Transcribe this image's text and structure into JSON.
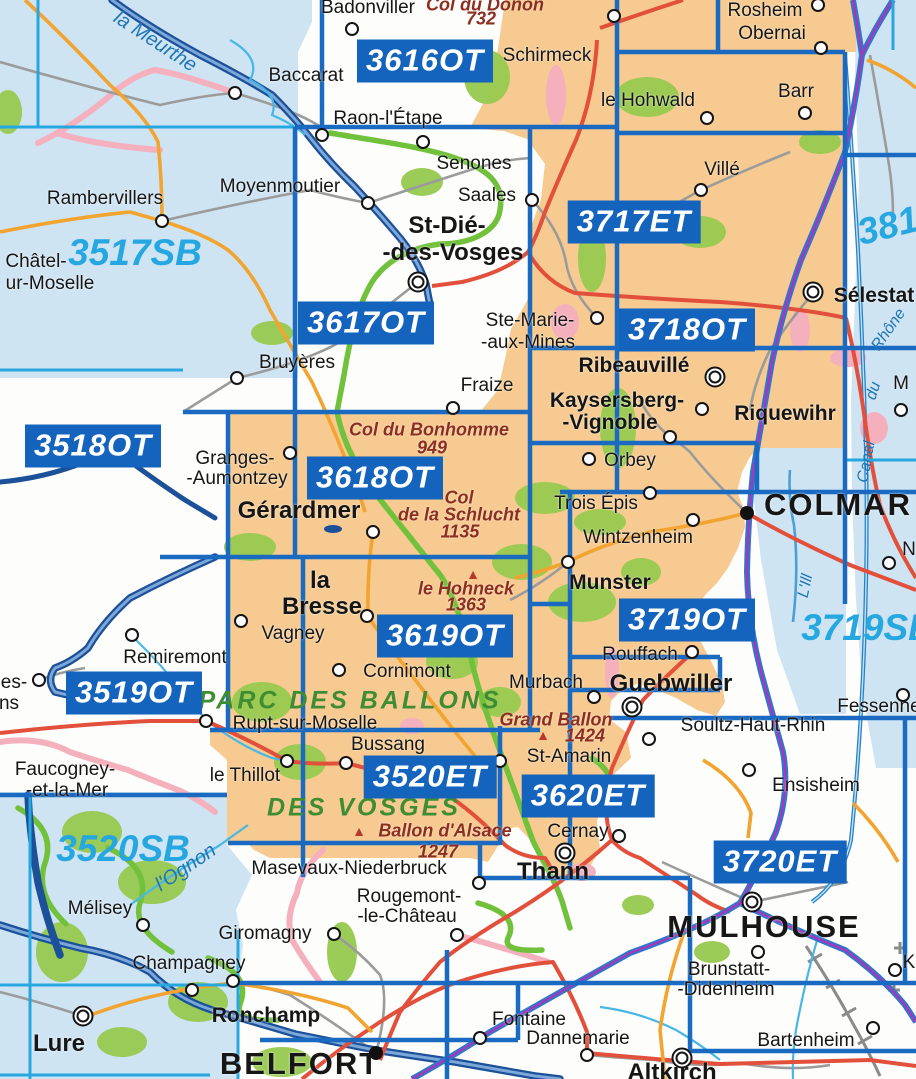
{
  "title": "IGN map sheet index - Vosges / Alsace",
  "colors": {
    "water": "#cfe4f3",
    "cover": "#f6ca90",
    "boxblue": "#1463bd",
    "gridblue": "#1a6ac2",
    "sbblue": "#27a7e0",
    "red": "#e2503c",
    "orange": "#f2a431",
    "pink": "#f5b0bd",
    "gpatch": "#97c94f",
    "groute": "#72c13c",
    "gray": "#9b9b9b",
    "riverdark": "#1c5098",
    "canal": "#49b7e5",
    "magenta": "#c12bb4"
  },
  "sheets": {
    "topo": [
      {
        "code": "3616OT",
        "x": 425,
        "y": 61
      },
      {
        "code": "3617OT",
        "x": 366,
        "y": 323
      },
      {
        "code": "3717ET",
        "x": 634,
        "y": 222
      },
      {
        "code": "3718OT",
        "x": 687,
        "y": 330
      },
      {
        "code": "3518OT",
        "x": 93,
        "y": 446
      },
      {
        "code": "3618OT",
        "x": 375,
        "y": 478
      },
      {
        "code": "3619OT",
        "x": 445,
        "y": 636
      },
      {
        "code": "3719OT",
        "x": 687,
        "y": 620
      },
      {
        "code": "3519OT",
        "x": 134,
        "y": 693
      },
      {
        "code": "3520ET",
        "x": 430,
        "y": 777
      },
      {
        "code": "3620ET",
        "x": 588,
        "y": 796
      },
      {
        "code": "3720ET",
        "x": 780,
        "y": 862
      }
    ],
    "serie_bleue": [
      {
        "code": "3517SB",
        "x": 135,
        "y": 253,
        "rot": 0
      },
      {
        "code": "3719SB",
        "x": 868,
        "y": 628,
        "rot": 0
      },
      {
        "code": "3520SB",
        "x": 123,
        "y": 849,
        "rot": 0
      },
      {
        "code": "381",
        "x": 888,
        "y": 226,
        "rot": -14
      }
    ]
  },
  "towns": [
    {
      "t": "Badonviller",
      "x": 368,
      "y": 8,
      "c": "md",
      "m": [
        352,
        29,
        "dot"
      ]
    },
    {
      "t": "Schirmeck",
      "x": 547,
      "y": 56,
      "c": "md",
      "m": [
        614,
        16,
        "dot"
      ]
    },
    {
      "t": "Rosheim",
      "x": 765,
      "y": 11,
      "c": "md",
      "m": [
        818,
        5,
        "dot"
      ]
    },
    {
      "t": "Obernai",
      "x": 772,
      "y": 34,
      "c": "md",
      "m": [
        821,
        48,
        "dot"
      ]
    },
    {
      "t": "Barr",
      "x": 796,
      "y": 92,
      "c": "md",
      "m": [
        805,
        113,
        "dot"
      ]
    },
    {
      "t": "le Hohwald",
      "x": 648,
      "y": 101,
      "c": "md",
      "m": [
        707,
        118,
        "dot"
      ]
    },
    {
      "t": "Baccarat",
      "x": 306,
      "y": 76,
      "c": "md",
      "m": [
        235,
        93,
        "dot"
      ]
    },
    {
      "t": "Raon-l'Étape",
      "x": 388,
      "y": 119,
      "c": "md",
      "m": [
        322,
        135,
        "dot"
      ]
    },
    {
      "t": "Senones",
      "x": 474,
      "y": 164,
      "c": "md",
      "m": [
        423,
        142,
        "dot"
      ]
    },
    {
      "t": "Moyenmoutier",
      "x": 280,
      "y": 187,
      "c": "md",
      "m": [
        368,
        203,
        "dot"
      ]
    },
    {
      "t": "Saales",
      "x": 487,
      "y": 196,
      "c": "md",
      "m": [
        532,
        200,
        "dot"
      ]
    },
    {
      "t": "Rambervillers",
      "x": 105,
      "y": 199,
      "c": "md",
      "m": [
        162,
        221,
        "dot"
      ]
    },
    {
      "t": "Châtel-",
      "x": 36,
      "y": 262,
      "c": "md"
    },
    {
      "t": "ur-Moselle",
      "x": 50,
      "y": 284,
      "c": "md"
    },
    {
      "t": "Villé",
      "x": 722,
      "y": 170,
      "c": "md",
      "m": [
        701,
        190,
        "dot"
      ]
    },
    {
      "t": "St-Dié-",
      "x": 447,
      "y": 226,
      "c": "blg"
    },
    {
      "t": "-des-Vosges",
      "x": 453,
      "y": 253,
      "c": "blg",
      "m": [
        418,
        282,
        "dbl"
      ]
    },
    {
      "t": "Ste-Marie-",
      "x": 530,
      "y": 321,
      "c": "md",
      "m": [
        597,
        318,
        "dot"
      ]
    },
    {
      "t": "-aux-Mines",
      "x": 528,
      "y": 343,
      "c": "md"
    },
    {
      "t": "Sélestat",
      "x": 874,
      "y": 296,
      "c": "b",
      "m": [
        813,
        292,
        "dbl"
      ]
    },
    {
      "t": "Ribeauvillé",
      "x": 634,
      "y": 366,
      "c": "b",
      "m": [
        715,
        377,
        "dbl"
      ]
    },
    {
      "t": "Kaysersberg-",
      "x": 617,
      "y": 401,
      "c": "b"
    },
    {
      "t": "-Vignoble",
      "x": 610,
      "y": 423,
      "c": "b",
      "m": [
        670,
        437,
        "dot"
      ]
    },
    {
      "t": "Riquewihr",
      "x": 785,
      "y": 414,
      "c": "b",
      "m": [
        702,
        409,
        "dot"
      ]
    },
    {
      "t": "Bruyères",
      "x": 297,
      "y": 363,
      "c": "md",
      "m": [
        237,
        378,
        "dot"
      ]
    },
    {
      "t": "Fraize",
      "x": 487,
      "y": 386,
      "c": "md",
      "m": [
        453,
        408,
        "dot"
      ]
    },
    {
      "t": "Granges-",
      "x": 235,
      "y": 459,
      "c": "md",
      "m": [
        290,
        453,
        "dot"
      ]
    },
    {
      "t": "-Aumontzey",
      "x": 237,
      "y": 479,
      "c": "md"
    },
    {
      "t": "Gérardmer",
      "x": 299,
      "y": 511,
      "c": "blg",
      "m": [
        373,
        532,
        "dot"
      ]
    },
    {
      "t": "Orbey",
      "x": 630,
      "y": 461,
      "c": "md",
      "m": [
        589,
        459,
        "dot"
      ]
    },
    {
      "t": "Trois Épis",
      "x": 596,
      "y": 504,
      "c": "md",
      "m": [
        650,
        493,
        "dot"
      ]
    },
    {
      "t": "Wintzenheim",
      "x": 638,
      "y": 538,
      "c": "md",
      "m": [
        693,
        520,
        "dot"
      ]
    },
    {
      "t": "COLMAR",
      "x": 838,
      "y": 505,
      "c": "city",
      "m": [
        747,
        513,
        "pref"
      ]
    },
    {
      "t": "Munster",
      "x": 610,
      "y": 583,
      "c": "b",
      "m": [
        568,
        562,
        "dot"
      ]
    },
    {
      "t": "la",
      "x": 320,
      "y": 581,
      "c": "blg"
    },
    {
      "t": "Bresse",
      "x": 322,
      "y": 607,
      "c": "blg",
      "m": [
        367,
        616,
        "dot"
      ]
    },
    {
      "t": "Vagney",
      "x": 293,
      "y": 634,
      "c": "md",
      "m": [
        241,
        621,
        "dot"
      ]
    },
    {
      "t": "Remiremont",
      "x": 175,
      "y": 658,
      "c": "md",
      "m": [
        132,
        635,
        "dot"
      ]
    },
    {
      "t": "es-",
      "x": 14,
      "y": 683,
      "c": "md",
      "m": [
        39,
        680,
        "dot"
      ]
    },
    {
      "t": "ns",
      "x": 9,
      "y": 704,
      "c": "md"
    },
    {
      "t": "Cornimont",
      "x": 407,
      "y": 672,
      "c": "md",
      "m": [
        339,
        670,
        "dot"
      ]
    },
    {
      "t": "Murbach",
      "x": 546,
      "y": 683,
      "c": "md"
    },
    {
      "t": "Rouffach",
      "x": 640,
      "y": 655,
      "c": "md",
      "m": [
        692,
        652,
        "dot"
      ]
    },
    {
      "t": "Guebwiller",
      "x": 671,
      "y": 684,
      "c": "blg",
      "m": [
        632,
        707,
        "dbl"
      ]
    },
    {
      "t": "Soultz-Haut-Rhin",
      "x": 753,
      "y": 726,
      "c": "md",
      "m": [
        649,
        739,
        "dot"
      ]
    },
    {
      "t": "Fessenheim",
      "x": 889,
      "y": 707,
      "c": "md",
      "m": [
        903,
        695,
        "dot"
      ]
    },
    {
      "t": "Rupt-sur-Moselle",
      "x": 305,
      "y": 724,
      "c": "md",
      "m": [
        206,
        721,
        "dot"
      ]
    },
    {
      "t": "Bussang",
      "x": 388,
      "y": 745,
      "c": "md",
      "m": [
        346,
        763,
        "dot"
      ]
    },
    {
      "t": "le Thillot",
      "x": 245,
      "y": 776,
      "c": "md",
      "m": [
        287,
        761,
        "dot"
      ]
    },
    {
      "t": "Faucogney-",
      "x": 65,
      "y": 770,
      "c": "md"
    },
    {
      "t": "-et-la-Mer",
      "x": 67,
      "y": 791,
      "c": "md"
    },
    {
      "t": "St-Amarin",
      "x": 569,
      "y": 757,
      "c": "md",
      "m": [
        500,
        761,
        "dot"
      ]
    },
    {
      "t": "Ensisheim",
      "x": 816,
      "y": 786,
      "c": "md",
      "m": [
        749,
        770,
        "dot"
      ]
    },
    {
      "t": "Cernay",
      "x": 578,
      "y": 832,
      "c": "md",
      "m": [
        619,
        836,
        "dot"
      ]
    },
    {
      "t": "Thann",
      "x": 553,
      "y": 872,
      "c": "blg",
      "m": [
        565,
        853,
        "dbl"
      ]
    },
    {
      "t": "Masevaux-Niederbruck",
      "x": 349,
      "y": 869,
      "c": "md",
      "m": [
        479,
        883,
        "dot"
      ]
    },
    {
      "t": "Rougemont-",
      "x": 409,
      "y": 897,
      "c": "md"
    },
    {
      "t": "-le-Château",
      "x": 407,
      "y": 917,
      "c": "md",
      "m": [
        457,
        935,
        "dot"
      ]
    },
    {
      "t": "Giromagny",
      "x": 265,
      "y": 934,
      "c": "md",
      "m": [
        334,
        934,
        "dot"
      ]
    },
    {
      "t": "Mélisey",
      "x": 100,
      "y": 909,
      "c": "md",
      "m": [
        143,
        925,
        "dot"
      ]
    },
    {
      "t": "Champagney",
      "x": 189,
      "y": 964,
      "c": "md",
      "m": [
        192,
        990,
        "dot"
      ]
    },
    {
      "t": "Ronchamp",
      "x": 266,
      "y": 1016,
      "c": "b",
      "m": [
        233,
        981,
        "dot"
      ]
    },
    {
      "t": "Lure",
      "x": 59,
      "y": 1044,
      "c": "blg",
      "m": [
        83,
        1016,
        "dbl"
      ]
    },
    {
      "t": "BELFORT",
      "x": 300,
      "y": 1064,
      "c": "city",
      "m": [
        376,
        1053,
        "pref"
      ]
    },
    {
      "t": "Fontaine",
      "x": 529,
      "y": 1020,
      "c": "md",
      "m": [
        480,
        1038,
        "dot"
      ]
    },
    {
      "t": "Dannemarie",
      "x": 578,
      "y": 1039,
      "c": "md",
      "m": [
        587,
        1055,
        "dot"
      ]
    },
    {
      "t": "Altkirch",
      "x": 672,
      "y": 1073,
      "c": "blg",
      "m": [
        682,
        1058,
        "dbl"
      ]
    },
    {
      "t": "Brunstatt-",
      "x": 729,
      "y": 970,
      "c": "md",
      "m": [
        758,
        952,
        "dot"
      ]
    },
    {
      "t": "-Didenheim",
      "x": 726,
      "y": 990,
      "c": "md"
    },
    {
      "t": "Bartenheim",
      "x": 806,
      "y": 1041,
      "c": "md",
      "m": [
        873,
        1028,
        "dot"
      ]
    },
    {
      "t": "MULHOUSE",
      "x": 764,
      "y": 927,
      "c": "city",
      "m": [
        752,
        902,
        "dbl"
      ]
    },
    {
      "t": "K",
      "x": 909,
      "y": 963,
      "c": "md",
      "m": [
        895,
        970,
        "dot"
      ]
    },
    {
      "t": "M",
      "x": 901,
      "y": 384,
      "c": "md",
      "m": [
        901,
        410,
        "dot"
      ]
    },
    {
      "t": "N",
      "x": 909,
      "y": 550,
      "c": "md",
      "m": [
        889,
        563,
        "dot"
      ]
    }
  ],
  "peaks": {
    "labels": [
      {
        "t": "Col du Donon",
        "x": 485,
        "y": 5
      },
      {
        "t": "732",
        "x": 481,
        "y": 19
      },
      {
        "t": "Col du Bonhomme",
        "x": 429,
        "y": 430
      },
      {
        "t": "949",
        "x": 432,
        "y": 448
      },
      {
        "t": "Col",
        "x": 459,
        "y": 498
      },
      {
        "t": "de la Schlucht",
        "x": 459,
        "y": 515
      },
      {
        "t": "1135",
        "x": 460,
        "y": 532
      },
      {
        "t": "le Hohneck",
        "x": 466,
        "y": 589
      },
      {
        "t": "1363",
        "x": 466,
        "y": 605
      },
      {
        "t": "Grand Ballon",
        "x": 556,
        "y": 720
      },
      {
        "t": "1424",
        "x": 585,
        "y": 736
      },
      {
        "t": "Ballon d'Alsace",
        "x": 445,
        "y": 831
      },
      {
        "t": "1247",
        "x": 438,
        "y": 852
      }
    ],
    "triangles": [
      [
        473,
        574
      ],
      [
        543,
        735
      ],
      [
        359,
        831
      ]
    ]
  },
  "parks": [
    {
      "t": "PARC DES BALLONS",
      "x": 350,
      "y": 701
    },
    {
      "t": "DES VOSGES",
      "x": 364,
      "y": 808
    }
  ],
  "river_labels": [
    {
      "t": "la Meurthe",
      "x": 155,
      "y": 42,
      "rot": 33,
      "c": "rv-lg"
    },
    {
      "t": "l'Ognon",
      "x": 186,
      "y": 868,
      "rot": -34,
      "c": "rv-lg"
    },
    {
      "t": "L'Ill",
      "x": 806,
      "y": 586,
      "rot": -78,
      "c": "rv-sm"
    },
    {
      "t": "Canal",
      "x": 867,
      "y": 462,
      "rot": -80,
      "c": "rv-sm"
    },
    {
      "t": "du",
      "x": 874,
      "y": 391,
      "rot": -72,
      "c": "rv-sm"
    },
    {
      "t": "Rhône",
      "x": 889,
      "y": 330,
      "rot": -55,
      "c": "rv-sm"
    }
  ],
  "extra_dots": [
    [
      594,
      697
    ]
  ]
}
